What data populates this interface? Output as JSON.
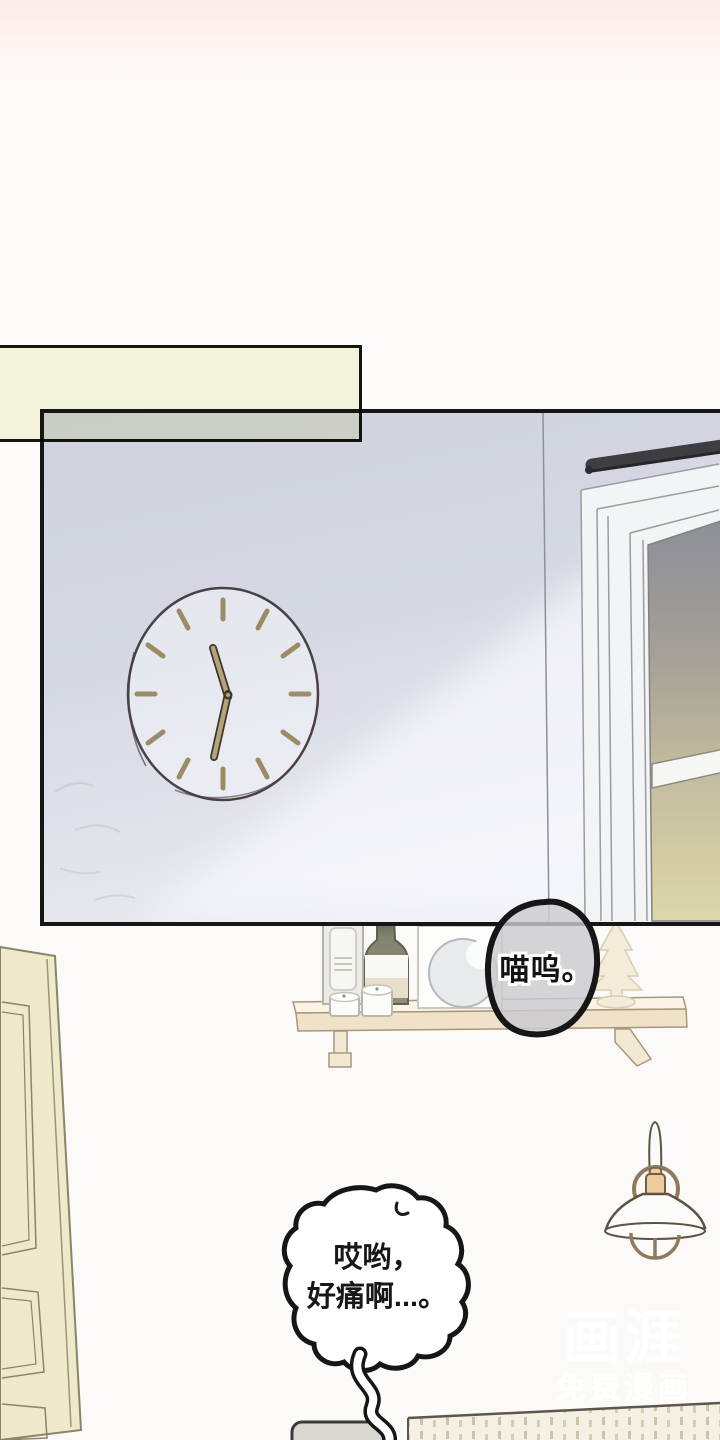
{
  "page": {
    "kind": "comic-page",
    "colors": {
      "page_bg": "#fbfaf8",
      "top_tint": "#fcebec",
      "panel_wall": "#d3d6e0",
      "panel_border": "#161616",
      "caption_fill": "#f8f8e2",
      "glass_top": "#8d8f98",
      "glass_bottom": "#ddd7ac",
      "wood_shelf": "#f0e5cf",
      "door_fill": "#eee9c9",
      "bubble_gray_fill": "#cbcbcf",
      "watermark_color": "#ffffff"
    }
  },
  "bubbles": {
    "meow": {
      "text": "喵呜。"
    },
    "pain": {
      "line1": "哎哟，",
      "line2": "好痛啊...。"
    }
  },
  "watermark": {
    "logo": "画涯",
    "subtitle": "免费漫画"
  },
  "illustrations": {
    "panel": "bedroom-wall-panel",
    "clock": "wall-clock-showing-hands",
    "curtain_rod": "dark-curtain-rod",
    "window": "window-frame-with-sunset-glass",
    "shelf": "wall-mounted-wood-shelf",
    "shelf_items": [
      "storage-box",
      "wine-bottle",
      "candle-jar-small",
      "candle-jar-large",
      "canvas-with-round-mirror",
      "mini-christmas-tree"
    ],
    "lamp": "pendant-cage-lamp",
    "door": "paneled-door",
    "cushion": "gray-rounded-cushion",
    "bed": "stitched-blanket-bed"
  }
}
